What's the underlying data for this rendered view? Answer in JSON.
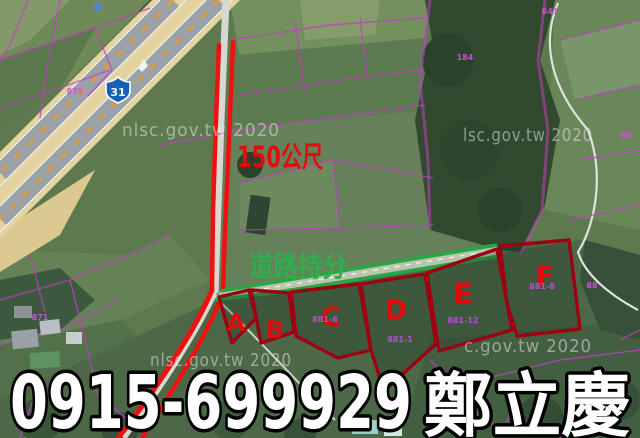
{
  "colors": {
    "annotation_red": "#e60a0a",
    "parcel_red": "#9c0212",
    "share_green": "#28a644",
    "cadastral_purple": "#bf3fbf",
    "highway_tan": "#e3d29b",
    "watermark_gray": "#e6eaec"
  },
  "watermarks": {
    "top_left": "nlsc.gov.tw 2020",
    "top_right": "lsc.gov.tw 2020",
    "bottom_left": "nlsc.gov.tw 2020",
    "bottom_right": "c.gov.tw 2020"
  },
  "highway": {
    "route_shield": "31"
  },
  "annotations": {
    "distance": "150公尺",
    "road_share": "道路持分"
  },
  "contact": {
    "phone": "0915-699929",
    "name": "鄭立慶"
  },
  "parcels": [
    {
      "label": "A"
    },
    {
      "label": "B"
    },
    {
      "label": "C",
      "number": "881-6"
    },
    {
      "label": "D",
      "number": "881-1"
    },
    {
      "label": "E",
      "number": "881-12"
    },
    {
      "label": "F",
      "number": "881-8"
    }
  ],
  "field_labels": [
    {
      "text": "875"
    },
    {
      "text": "841"
    },
    {
      "text": "184"
    },
    {
      "text": "86"
    },
    {
      "text": "88"
    },
    {
      "text": "871"
    }
  ]
}
